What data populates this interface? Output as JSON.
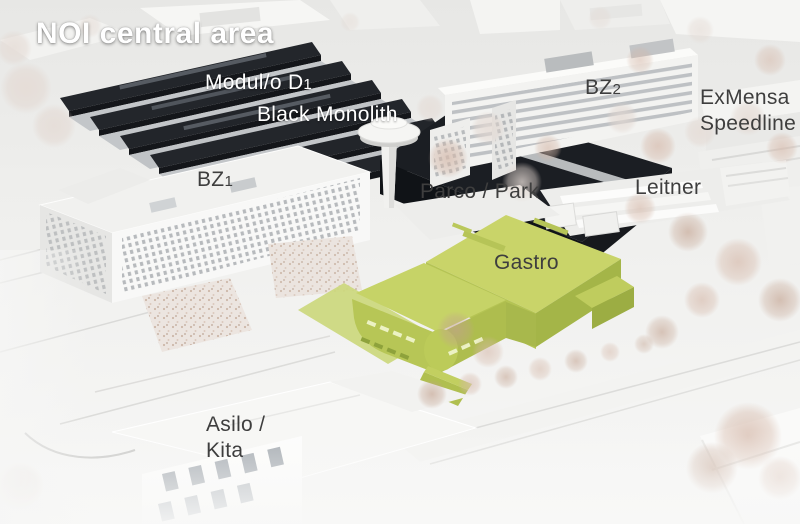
{
  "title": "NOI central area",
  "labels": {
    "modulo_d1": {
      "text": "Modul/o D",
      "sub": "1"
    },
    "black_monolith": {
      "text": "Black Monolith"
    },
    "bz2": {
      "text": "BZ",
      "sub": "2"
    },
    "exmensa": {
      "line1": "ExMensa",
      "line2": "Speedline"
    },
    "bz1": {
      "text": "BZ",
      "sub": "1"
    },
    "parco": {
      "text": "Parco / Park"
    },
    "leitner": {
      "text": "Leitner"
    },
    "gastro": {
      "text": "Gastro"
    },
    "asilo": {
      "line1": "Asilo /",
      "line2": "Kita"
    }
  },
  "colors": {
    "gastro_highlight": "#c3d162",
    "dark_buildings": "#1d2025",
    "model_white": "#f2f2f0",
    "label_dark": "#3e3e3e",
    "label_light": "#ffffff"
  }
}
